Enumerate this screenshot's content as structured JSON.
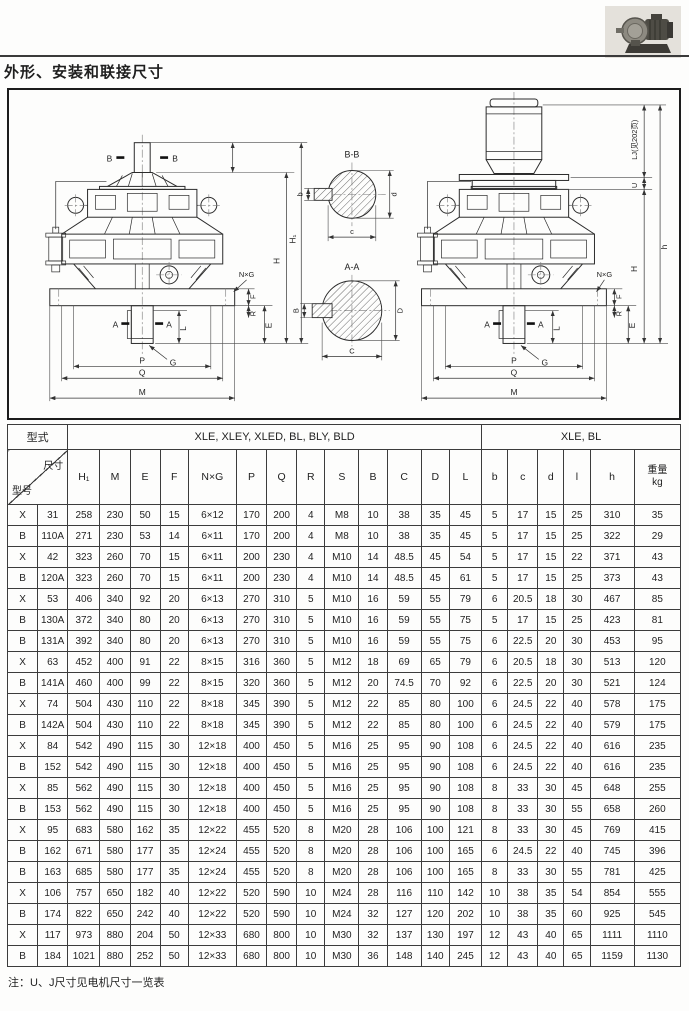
{
  "page": {
    "title": "外形、安装和联接尺寸",
    "note": "注：U、J尺寸见电机尺寸一览表"
  },
  "drawing": {
    "labels": {
      "b_mark": "B",
      "a_mark": "A",
      "h1": "H₁",
      "h_cap": "H",
      "h_total": "h",
      "lj": "LJ(见202页)",
      "u": "U",
      "nxg": "N×G",
      "f": "F",
      "r": "R",
      "e": "E",
      "l": "L",
      "g": "G",
      "p": "P",
      "q": "Q",
      "m": "M",
      "bb_title": "B-B",
      "aa_title": "A-A",
      "sec_small_b": "b",
      "sec_small_c": "c",
      "sec_small_d": "d",
      "sec_big_b": "B",
      "sec_big_c": "C",
      "sec_big_d": "D"
    }
  },
  "table": {
    "header": {
      "type_label": "型式",
      "group1": "XLE, XLEY, XLED, BL, BLY, BLD",
      "group2": "XLE, BL",
      "dim_label": "尺寸",
      "model_label": "型号",
      "columns": [
        "H₁",
        "M",
        "E",
        "F",
        "N×G",
        "P",
        "Q",
        "R",
        "S",
        "B",
        "C",
        "D",
        "L",
        "b",
        "c",
        "d",
        "l",
        "h"
      ],
      "weight_label": "重量",
      "weight_unit": "kg"
    },
    "rows": [
      [
        "X",
        "31",
        "258",
        "230",
        "50",
        "15",
        "6×12",
        "170",
        "200",
        "4",
        "M8",
        "10",
        "38",
        "35",
        "45",
        "5",
        "17",
        "15",
        "25",
        "310",
        "35"
      ],
      [
        "B",
        "110A",
        "271",
        "230",
        "53",
        "14",
        "6×11",
        "170",
        "200",
        "4",
        "M8",
        "10",
        "38",
        "35",
        "45",
        "5",
        "17",
        "15",
        "25",
        "322",
        "29"
      ],
      [
        "X",
        "42",
        "323",
        "260",
        "70",
        "15",
        "6×11",
        "200",
        "230",
        "4",
        "M10",
        "14",
        "48.5",
        "45",
        "54",
        "5",
        "17",
        "15",
        "22",
        "371",
        "43"
      ],
      [
        "B",
        "120A",
        "323",
        "260",
        "70",
        "15",
        "6×11",
        "200",
        "230",
        "4",
        "M10",
        "14",
        "48.5",
        "45",
        "61",
        "5",
        "17",
        "15",
        "25",
        "373",
        "43"
      ],
      [
        "X",
        "53",
        "406",
        "340",
        "92",
        "20",
        "6×13",
        "270",
        "310",
        "5",
        "M10",
        "16",
        "59",
        "55",
        "79",
        "6",
        "20.5",
        "18",
        "30",
        "467",
        "85"
      ],
      [
        "B",
        "130A",
        "372",
        "340",
        "80",
        "20",
        "6×13",
        "270",
        "310",
        "5",
        "M10",
        "16",
        "59",
        "55",
        "75",
        "5",
        "17",
        "15",
        "25",
        "423",
        "81"
      ],
      [
        "B",
        "131A",
        "392",
        "340",
        "80",
        "20",
        "6×13",
        "270",
        "310",
        "5",
        "M10",
        "16",
        "59",
        "55",
        "75",
        "6",
        "22.5",
        "20",
        "30",
        "453",
        "95"
      ],
      [
        "X",
        "63",
        "452",
        "400",
        "91",
        "22",
        "8×15",
        "316",
        "360",
        "5",
        "M12",
        "18",
        "69",
        "65",
        "79",
        "6",
        "20.5",
        "18",
        "30",
        "513",
        "120"
      ],
      [
        "B",
        "141A",
        "460",
        "400",
        "99",
        "22",
        "8×15",
        "320",
        "360",
        "5",
        "M12",
        "20",
        "74.5",
        "70",
        "92",
        "6",
        "22.5",
        "20",
        "30",
        "521",
        "124"
      ],
      [
        "X",
        "74",
        "504",
        "430",
        "110",
        "22",
        "8×18",
        "345",
        "390",
        "5",
        "M12",
        "22",
        "85",
        "80",
        "100",
        "6",
        "24.5",
        "22",
        "40",
        "578",
        "175"
      ],
      [
        "B",
        "142A",
        "504",
        "430",
        "110",
        "22",
        "8×18",
        "345",
        "390",
        "5",
        "M12",
        "22",
        "85",
        "80",
        "100",
        "6",
        "24.5",
        "22",
        "40",
        "579",
        "175"
      ],
      [
        "X",
        "84",
        "542",
        "490",
        "115",
        "30",
        "12×18",
        "400",
        "450",
        "5",
        "M16",
        "25",
        "95",
        "90",
        "108",
        "6",
        "24.5",
        "22",
        "40",
        "616",
        "235"
      ],
      [
        "B",
        "152",
        "542",
        "490",
        "115",
        "30",
        "12×18",
        "400",
        "450",
        "5",
        "M16",
        "25",
        "95",
        "90",
        "108",
        "6",
        "24.5",
        "22",
        "40",
        "616",
        "235"
      ],
      [
        "X",
        "85",
        "562",
        "490",
        "115",
        "30",
        "12×18",
        "400",
        "450",
        "5",
        "M16",
        "25",
        "95",
        "90",
        "108",
        "8",
        "33",
        "30",
        "45",
        "648",
        "255"
      ],
      [
        "B",
        "153",
        "562",
        "490",
        "115",
        "30",
        "12×18",
        "400",
        "450",
        "5",
        "M16",
        "25",
        "95",
        "90",
        "108",
        "8",
        "33",
        "30",
        "55",
        "658",
        "260"
      ],
      [
        "X",
        "95",
        "683",
        "580",
        "162",
        "35",
        "12×22",
        "455",
        "520",
        "8",
        "M20",
        "28",
        "106",
        "100",
        "121",
        "8",
        "33",
        "30",
        "45",
        "769",
        "415"
      ],
      [
        "B",
        "162",
        "671",
        "580",
        "177",
        "35",
        "12×24",
        "455",
        "520",
        "8",
        "M20",
        "28",
        "106",
        "100",
        "165",
        "6",
        "24.5",
        "22",
        "40",
        "745",
        "396"
      ],
      [
        "B",
        "163",
        "685",
        "580",
        "177",
        "35",
        "12×24",
        "455",
        "520",
        "8",
        "M20",
        "28",
        "106",
        "100",
        "165",
        "8",
        "33",
        "30",
        "55",
        "781",
        "425"
      ],
      [
        "X",
        "106",
        "757",
        "650",
        "182",
        "40",
        "12×22",
        "520",
        "590",
        "10",
        "M24",
        "28",
        "116",
        "110",
        "142",
        "10",
        "38",
        "35",
        "54",
        "854",
        "555"
      ],
      [
        "B",
        "174",
        "822",
        "650",
        "242",
        "40",
        "12×22",
        "520",
        "590",
        "10",
        "M24",
        "32",
        "127",
        "120",
        "202",
        "10",
        "38",
        "35",
        "60",
        "925",
        "545"
      ],
      [
        "X",
        "117",
        "973",
        "880",
        "204",
        "50",
        "12×33",
        "680",
        "800",
        "10",
        "M30",
        "32",
        "137",
        "130",
        "197",
        "12",
        "43",
        "40",
        "65",
        "1111",
        "1110"
      ],
      [
        "B",
        "184",
        "1021",
        "880",
        "252",
        "50",
        "12×33",
        "680",
        "800",
        "10",
        "M30",
        "36",
        "148",
        "140",
        "245",
        "12",
        "43",
        "40",
        "65",
        "1159",
        "1130"
      ]
    ]
  }
}
